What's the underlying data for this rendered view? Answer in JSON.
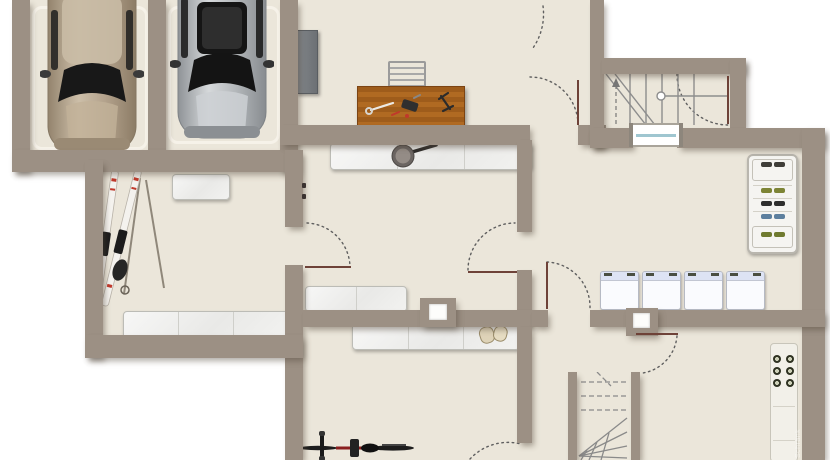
{
  "title": "Basement floor plan",
  "watermark": {
    "text": "Schrank"
  },
  "colors": {
    "wall": "#9c9084",
    "floor": "#ebe6da",
    "bg": "#ffffff",
    "shelf": "#f4f4f2",
    "shelf-border": "#bcbcb6",
    "wood": "#ab641e",
    "door-leaf": "#6e4238",
    "arc": "#5f5f5f",
    "glass": "#9fc6d0",
    "appliance-top": "#dde3f4",
    "cabinet": "#75797d",
    "stair-line": "#8d8d8d",
    "counter": "#f2f0e9",
    "burner": "#2f3222",
    "car1": "#b5a48e",
    "car2": "#b5b8bb"
  },
  "rooms": [
    {
      "name": "garage",
      "cars": 2,
      "parking_bays": 2
    },
    {
      "name": "workshop",
      "fixtures": [
        "wall-cabinet",
        "workbench",
        "tool-rack"
      ],
      "tools_on_bench": 3
    },
    {
      "name": "upper-stairwell",
      "stairs": "winder",
      "window": true,
      "door": true
    },
    {
      "name": "ski-storage",
      "ski_pairs": 2,
      "ski_poles": 2,
      "shelf_units": 2
    },
    {
      "name": "hallway",
      "shelf_units": 2,
      "pan_on_shelf": 1,
      "chimney_blocks": 1
    },
    {
      "name": "laundry",
      "washing_machine_count": 4,
      "shoe_rack": true,
      "chimney_blocks": 1
    },
    {
      "name": "bike-room",
      "bicycles": 1,
      "shelf_segments": 3,
      "gloves_on_shelf": 1
    },
    {
      "name": "lower-stair-hall",
      "stairs": "winder-down",
      "kitchenette_burners": 6
    }
  ],
  "fixtures": {
    "washing_machines": {
      "count": 4
    },
    "burners": {
      "count": 6
    },
    "shoe_rows": [
      {
        "top": 6,
        "color": "#3f3d38"
      },
      {
        "top": 32,
        "color": "#7d8435"
      },
      {
        "top": 45,
        "color": "#2e2e2e"
      },
      {
        "top": 58,
        "color": "#5d7f9e"
      },
      {
        "top": 76,
        "color": "#6f7a2f"
      }
    ]
  }
}
